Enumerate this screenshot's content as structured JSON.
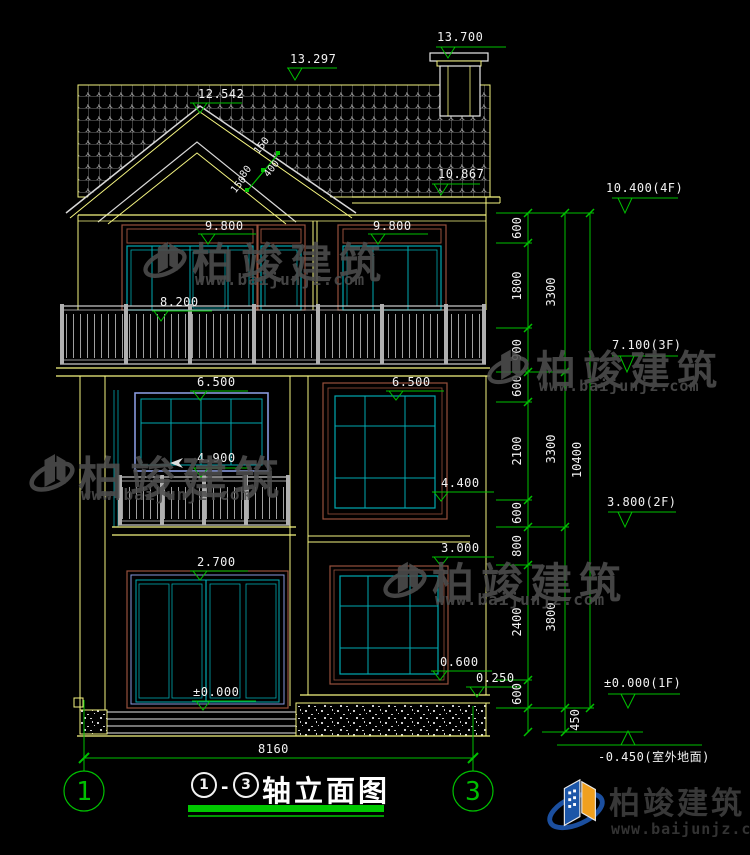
{
  "labels": {
    "e13700": "13.700",
    "e13297": "13.297",
    "e12542": "12.542",
    "e10867": "10.867",
    "e9800_left": "9.800",
    "e9800_right": "9.800",
    "e8200": "8.200",
    "e6500_left": "6.500",
    "e6500_right": "6.500",
    "e4900": "4.900",
    "e4400": "4.400",
    "e3000": "3.000",
    "e2700": "2.700",
    "e0600": "0.600",
    "e0250": "0.250",
    "e0000": "±0.000"
  },
  "right_marks": {
    "f4": "10.400(4F)",
    "f3": "7.100(3F)",
    "f2": "3.800(2F)",
    "f1": "±0.000(1F)",
    "ground": "-0.450(室外地面)"
  },
  "dims": {
    "total_width": "8160",
    "total_height": "10400",
    "d450": "450",
    "inner": [
      "600",
      "1800",
      "900",
      "600",
      "2100",
      "600",
      "800",
      "2400",
      "600"
    ],
    "mid": [
      "3300",
      "3300",
      "3800"
    ],
    "slope": [
      "150",
      "400",
      "80",
      "150"
    ]
  },
  "axes": {
    "left": "1",
    "right": "3"
  },
  "title": {
    "axis_a": "1",
    "dash": "-",
    "axis_b": "3",
    "name": "轴立面图"
  },
  "watermark": {
    "brand": "柏竣建筑",
    "url": "www.baijunjz.com"
  },
  "logo": {
    "brand": "柏竣建筑",
    "url": "www.baijunjz.com"
  }
}
